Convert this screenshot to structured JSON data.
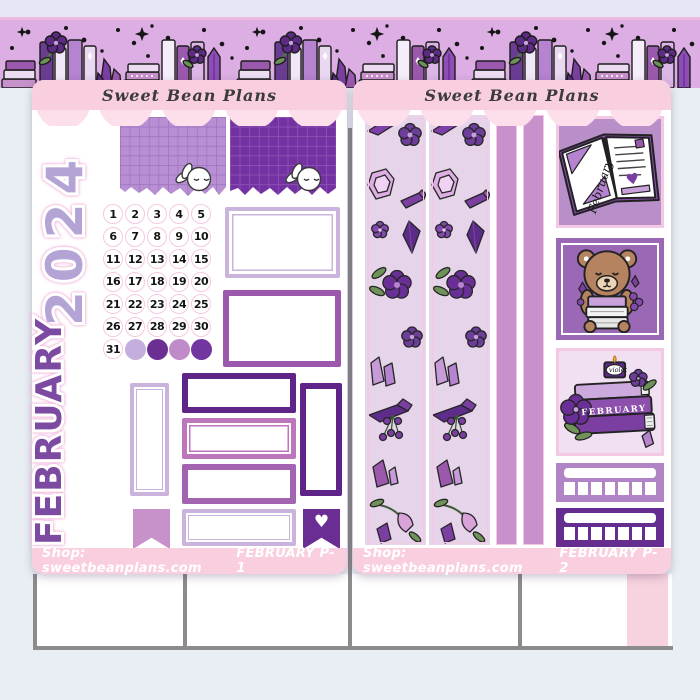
{
  "brand": "Sweet Bean Plans",
  "shop_label": "Shop: sweetbeanplans.com",
  "icons": {
    "heart": "♥"
  },
  "sheet1": {
    "page_label": "FEBRUARY P-1",
    "year": "2024",
    "month": "FEBRUARY",
    "calendar_days": [
      "1",
      "2",
      "3",
      "4",
      "5",
      "6",
      "7",
      "8",
      "9",
      "10",
      "11",
      "12",
      "13",
      "14",
      "15",
      "16",
      "17",
      "18",
      "19",
      "20",
      "21",
      "22",
      "23",
      "24",
      "25",
      "26",
      "27",
      "28",
      "29",
      "30",
      "31"
    ],
    "day_dot_colors": [
      "#c3aedd",
      "#6b2e92",
      "#c08bc9",
      "#7136a0"
    ]
  },
  "sheet2": {
    "page_label": "FEBRUARY P-2",
    "journal_label": "February",
    "candle_label": "violet",
    "book_spine_label": "FEBRUARY",
    "tracker_box_count": 7
  },
  "colors": {
    "bg": "#e9eef4",
    "top_strip": "#e7e6f6",
    "band_bg": "#dcaee4",
    "band_line": "#f0bade",
    "header_pink": "#f9cfe0",
    "scallop_pink": "#fcdfeb",
    "footer_pink": "#f9cfe0",
    "footer_text": "#ffffff",
    "script_text": "#3b3b3b",
    "year": "#b4a3d5",
    "month": "#7c4ba1",
    "cal_ring": "#f5c9e3",
    "grid1_bg": "#b78fd2",
    "grid1_line": "#a273c2",
    "grid2_bg": "#7431a2",
    "grid2_line": "#8d55b5",
    "box_light": "#cab4dd",
    "box_mid": "#9c58ad",
    "box_mid2": "#a263b1",
    "box_dark": "#5e2487",
    "box_orchid": "#bd76ba",
    "flag_light": "#c791c9",
    "flag_dark": "#6a2d94",
    "washi_bg": "#e6d4ea",
    "washi_edge": "#f4c8e3",
    "strip_solid": "#c891cc",
    "journal_bg": "#b98fc9",
    "bear_bg": "#9a68b5",
    "books_bg": "#f0e0f1",
    "tracker1": "#b184c5",
    "tracker2": "#652d90",
    "gray": "#8c8c8c",
    "edge_pink": "#f7d3e0"
  }
}
